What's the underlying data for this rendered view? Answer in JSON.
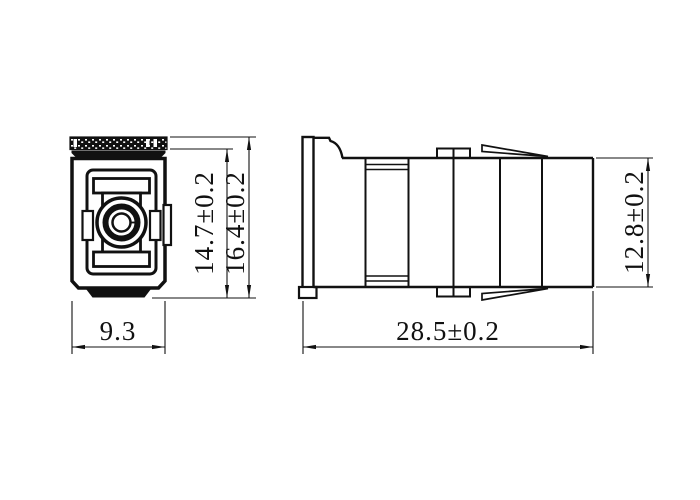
{
  "drawing": {
    "background_color": "#ffffff",
    "line_color": "#111111",
    "views": {
      "front": {
        "name": "front-view"
      },
      "side": {
        "name": "side-view"
      }
    },
    "dimensions": {
      "front_inner_height": {
        "label": "14.7±0.2"
      },
      "front_outer_height": {
        "label": "16.4±0.2"
      },
      "front_width": {
        "label": "9.3"
      },
      "side_length": {
        "label": "28.5±0.2"
      },
      "side_height": {
        "label": "12.8±0.2"
      }
    }
  }
}
